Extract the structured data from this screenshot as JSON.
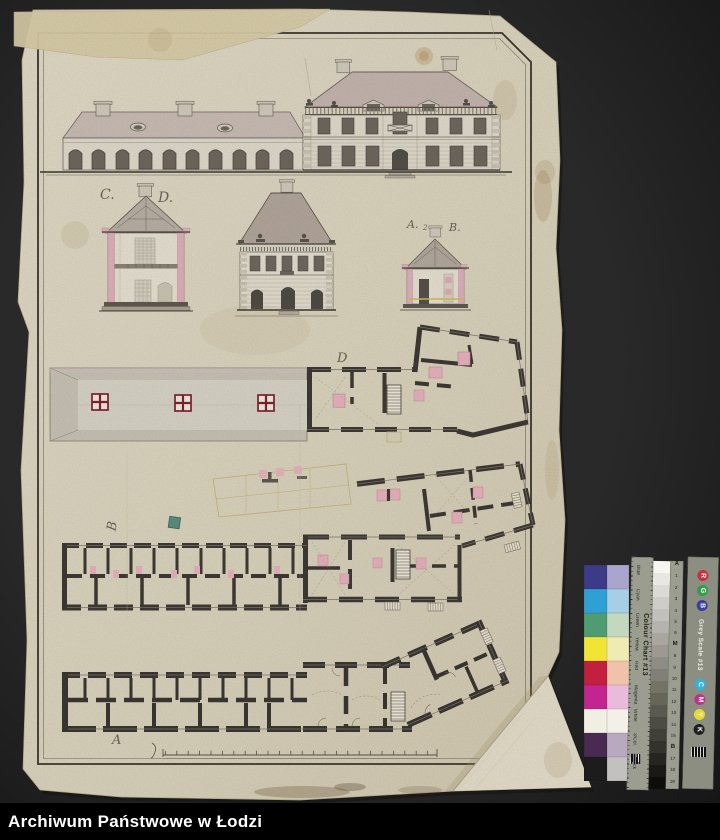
{
  "caption": {
    "archive_name": "Archiwum Państwowe w Łodzi"
  },
  "document": {
    "plate_labels": {
      "section_c": "C.",
      "section_d": "D.",
      "section_a": "A.",
      "section_a_index": "2",
      "section_b": "B.",
      "plan_first_floor": "D",
      "plan_ground_floor": "B",
      "plan_cellar": "A"
    }
  },
  "color_chart": {
    "title": "Colour Chart #13",
    "row_labels": [
      "Blue",
      "Cyan",
      "Green",
      "Yellow",
      "Red",
      "Magenta",
      "White",
      "3/Col.",
      "Black"
    ],
    "saturated_colors": [
      "#3d3a88",
      "#2f9fd6",
      "#4f9c72",
      "#f2e435",
      "#c2203e",
      "#c22590",
      "#f1eee3",
      "#4a2a50",
      "#1c1c1c"
    ],
    "pale_colors": [
      "#a9a5cf",
      "#a6cee6",
      "#c4d7bf",
      "#f0ebb2",
      "#f0c2aa",
      "#e9bada",
      "#f3f0e7",
      "#b9a9be",
      "#c2c1bf"
    ],
    "grey_scale": {
      "title": "Grey Scale #13",
      "scale_marks": [
        "A",
        "1",
        "2",
        "3",
        "4",
        "5",
        "6",
        "M",
        "8",
        "9",
        "10",
        "11",
        "12",
        "13",
        "14",
        "15",
        "B",
        "17",
        "18",
        "19"
      ]
    },
    "rgb_letters": [
      "R",
      "G",
      "B"
    ],
    "cmyk_letters": [
      "C",
      "M",
      "Y",
      "K"
    ],
    "rgb_colors": [
      "#c5303c",
      "#2f9e4c",
      "#3a3e9c"
    ],
    "cmyk_colors": [
      "#2fb4e0",
      "#c2308e",
      "#e8d832",
      "#1e1e1e"
    ]
  },
  "colors": {
    "background": "#2b2b2b",
    "paper": "#d9d2bd",
    "ink": "#3e3935",
    "pink_wash": "#ddafb9",
    "roof_wash": "#c3b3ad",
    "caption_bg": "#000000",
    "caption_text": "#ffffff"
  }
}
